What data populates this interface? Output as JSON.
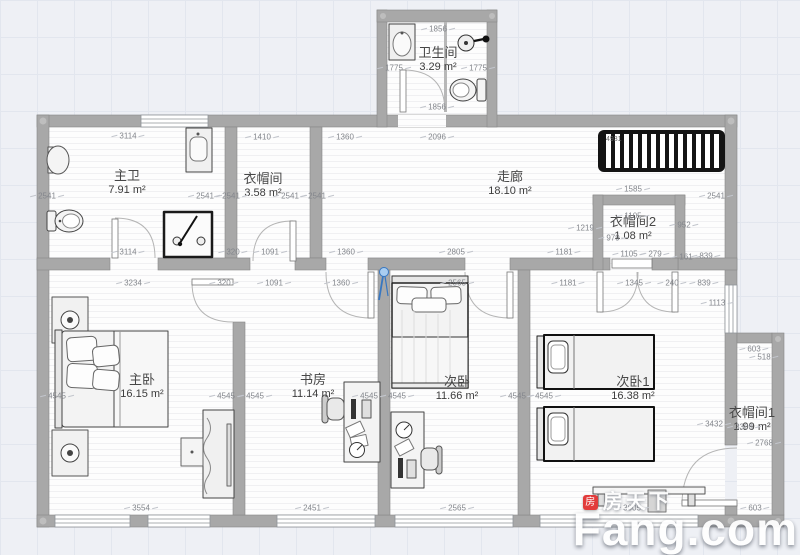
{
  "watermark": {
    "icon_text": "房",
    "brand_cn": "房天下",
    "brand_en": "Fang.com"
  },
  "fixtures": {
    "stairs_label": "4931"
  },
  "colors": {
    "wall": "#a8a8a8",
    "wall_border": "#878787",
    "floor": "#fdfdfd",
    "dim_text": "#83868c",
    "room_text": "#474747",
    "accent_blue": "#3777c2",
    "stairs_black": "#141414",
    "watermark_red": "#e23b3b"
  },
  "rooms": [
    {
      "id": "zhuwei",
      "name": "主卫",
      "area": "7.91 m²",
      "x": 127,
      "y": 183
    },
    {
      "id": "yimaojian",
      "name": "衣帽间",
      "area": "3.58 m²",
      "x": 263,
      "y": 186
    },
    {
      "id": "weishengjian",
      "name": "卫生间",
      "area": "3.29 m²",
      "x": 438,
      "y": 60
    },
    {
      "id": "zoulang",
      "name": "走廊",
      "area": "18.10 m²",
      "x": 510,
      "y": 184
    },
    {
      "id": "yimaojian2",
      "name": "衣帽间2",
      "area": "1.08 m²",
      "x": 633,
      "y": 229
    },
    {
      "id": "zhuwo",
      "name": "主卧",
      "area": "16.15 m²",
      "x": 142,
      "y": 387
    },
    {
      "id": "shufang",
      "name": "书房",
      "area": "11.14 m²",
      "x": 313,
      "y": 387
    },
    {
      "id": "ciwo",
      "name": "次卧",
      "area": "11.66 m²",
      "x": 457,
      "y": 389
    },
    {
      "id": "ciwo1",
      "name": "次卧1",
      "area": "16.38 m²",
      "x": 633,
      "y": 389
    },
    {
      "id": "yimaojian1",
      "name": "衣帽间1",
      "area": "1.99 m²",
      "x": 752,
      "y": 420
    }
  ],
  "dimensions": [
    {
      "t": "3114",
      "x": 128,
      "y": 136
    },
    {
      "t": "1410",
      "x": 262,
      "y": 137
    },
    {
      "t": "1360",
      "x": 345,
      "y": 137
    },
    {
      "t": "2096",
      "x": 437,
      "y": 137
    },
    {
      "t": "1856",
      "x": 438,
      "y": 29
    },
    {
      "t": "1775",
      "x": 394,
      "y": 68
    },
    {
      "t": "1775",
      "x": 478,
      "y": 68
    },
    {
      "t": "1856",
      "x": 437,
      "y": 107
    },
    {
      "t": "2541",
      "x": 47,
      "y": 196
    },
    {
      "t": "2541",
      "x": 205,
      "y": 196
    },
    {
      "t": "2541",
      "x": 231,
      "y": 196
    },
    {
      "t": "2541",
      "x": 290,
      "y": 196
    },
    {
      "t": "2541",
      "x": 317,
      "y": 196
    },
    {
      "t": "2541",
      "x": 716,
      "y": 196
    },
    {
      "t": "1585",
      "x": 633,
      "y": 189
    },
    {
      "t": "1105",
      "x": 633,
      "y": 216
    },
    {
      "t": "1219",
      "x": 585,
      "y": 228
    },
    {
      "t": "952",
      "x": 684,
      "y": 225
    },
    {
      "t": "979",
      "x": 613,
      "y": 238
    },
    {
      "t": "1105",
      "x": 629,
      "y": 254
    },
    {
      "t": "279",
      "x": 655,
      "y": 254
    },
    {
      "t": "161",
      "x": 686,
      "y": 257
    },
    {
      "t": "839",
      "x": 706,
      "y": 256
    },
    {
      "t": "1113",
      "x": 717,
      "y": 303
    },
    {
      "t": "3114",
      "x": 128,
      "y": 252
    },
    {
      "t": "320",
      "x": 233,
      "y": 252
    },
    {
      "t": "1091",
      "x": 270,
      "y": 252
    },
    {
      "t": "1360",
      "x": 346,
      "y": 252
    },
    {
      "t": "2805",
      "x": 456,
      "y": 252
    },
    {
      "t": "1181",
      "x": 564,
      "y": 252
    },
    {
      "t": "3234",
      "x": 133,
      "y": 283
    },
    {
      "t": "320",
      "x": 224,
      "y": 283
    },
    {
      "t": "1091",
      "x": 274,
      "y": 283
    },
    {
      "t": "1360",
      "x": 341,
      "y": 283
    },
    {
      "t": "2565",
      "x": 457,
      "y": 283
    },
    {
      "t": "1181",
      "x": 568,
      "y": 283
    },
    {
      "t": "1345",
      "x": 634,
      "y": 283
    },
    {
      "t": "240",
      "x": 672,
      "y": 283
    },
    {
      "t": "839",
      "x": 704,
      "y": 283
    },
    {
      "t": "4545",
      "x": 57,
      "y": 396
    },
    {
      "t": "4545",
      "x": 226,
      "y": 396
    },
    {
      "t": "4545",
      "x": 255,
      "y": 396
    },
    {
      "t": "4545",
      "x": 369,
      "y": 396
    },
    {
      "t": "4545",
      "x": 397,
      "y": 396
    },
    {
      "t": "4545",
      "x": 517,
      "y": 396
    },
    {
      "t": "4545",
      "x": 544,
      "y": 396
    },
    {
      "t": "3432",
      "x": 714,
      "y": 424
    },
    {
      "t": "603",
      "x": 754,
      "y": 349
    },
    {
      "t": "518",
      "x": 764,
      "y": 357
    },
    {
      "t": "3308",
      "x": 744,
      "y": 427
    },
    {
      "t": "2768",
      "x": 764,
      "y": 443
    },
    {
      "t": "603",
      "x": 755,
      "y": 508
    },
    {
      "t": "3554",
      "x": 141,
      "y": 508
    },
    {
      "t": "2451",
      "x": 312,
      "y": 508
    },
    {
      "t": "2565",
      "x": 457,
      "y": 508
    },
    {
      "t": "3605",
      "x": 632,
      "y": 508
    }
  ]
}
